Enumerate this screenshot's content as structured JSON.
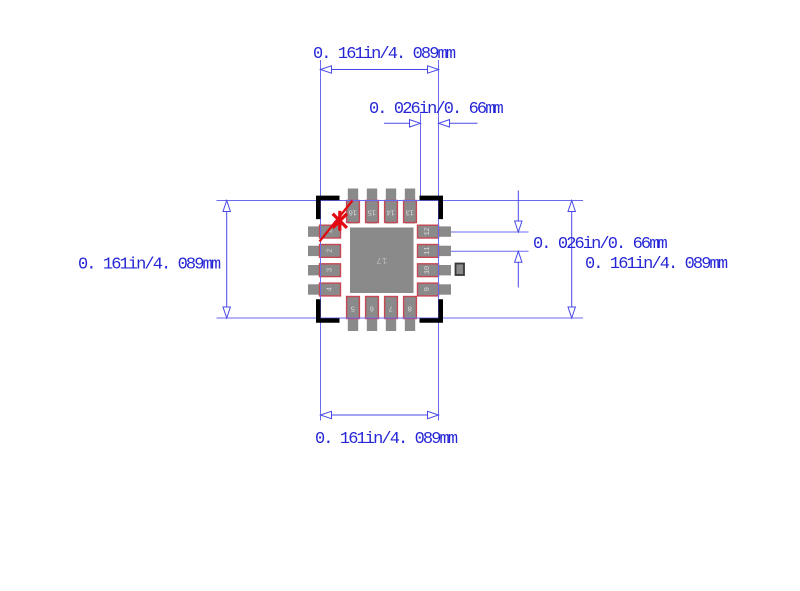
{
  "diagram": {
    "dimension_labels": {
      "top_width": "0. 161in/4. 089mm",
      "top_pitch": "0. 026in/0. 66mm",
      "left_height": "0. 161in/4. 089mm",
      "right_pitch": "0. 026in/0. 66mm",
      "right_height": "0. 161in/4. 089mm",
      "bottom_width": "0. 161in/4. 089mm"
    },
    "package": {
      "center_pad_label": "17",
      "pin_labels": {
        "top": [
          "16",
          "15",
          "14",
          "13"
        ],
        "left": [
          "1",
          "2",
          "3",
          "4"
        ],
        "right": [
          "12",
          "11",
          "10",
          "9"
        ],
        "bottom": [
          "5",
          "6",
          "7",
          "8"
        ]
      }
    },
    "colors": {
      "background": "#ffffff",
      "dimension_text": "#2626d6",
      "dimension_line": "#4848e8",
      "extension_line": "#6a6af0",
      "pad_fill": "#8a8a8a",
      "pad_outline": "#c64753",
      "pin_label_text": "#d8d8d8",
      "center_pad_text": "#bababa",
      "corner_bracket": "#000000",
      "pin1_marker": "#e20a10",
      "via_outline": "#383838"
    }
  }
}
